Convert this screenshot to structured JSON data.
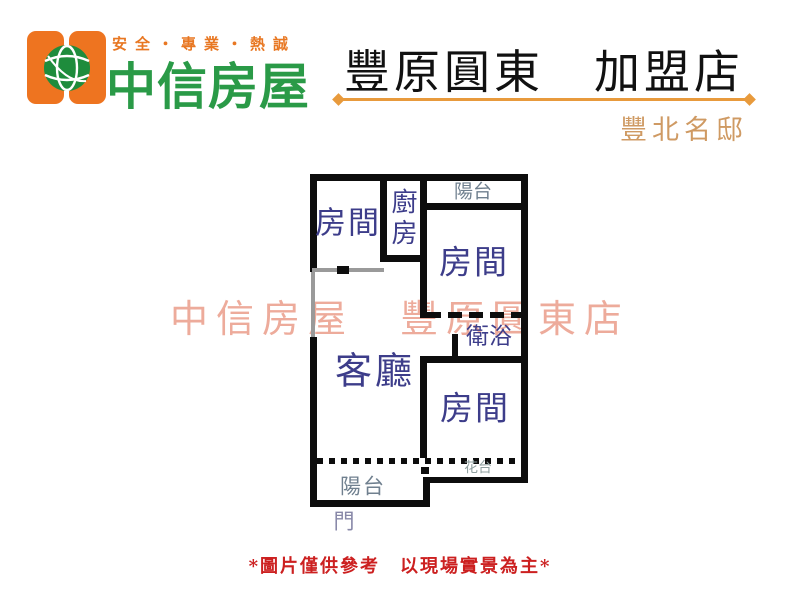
{
  "header": {
    "slogan": "安全・專業・熱誠",
    "brand": "中信房屋",
    "store_title": "豐原圓東　加盟店",
    "property_name": "豐北名邸",
    "colors": {
      "brand_orange": "#ee7420",
      "slogan_orange": "#e87722",
      "brand_green": "#2a9a47",
      "title_black": "#111111",
      "divider_orange": "#e89a3c",
      "property_tan": "#cf9a63"
    }
  },
  "icons": {
    "logo_globe": "globe-icon",
    "divider_ends": "diamond-arrow"
  },
  "floorplan": {
    "watermark": "中信房屋　豐原圓東店",
    "watermark_color": "#e0674a",
    "label_color": "#3d3d8a",
    "wall_color": "#0d0d0d",
    "gray_wall_color": "#9a9a9a",
    "rooms": [
      {
        "id": "bedroom-1",
        "label": "房間"
      },
      {
        "id": "kitchen",
        "label": "廚房"
      },
      {
        "id": "balcony-top",
        "label": "陽台"
      },
      {
        "id": "bedroom-2",
        "label": "房間"
      },
      {
        "id": "bathroom",
        "label": "衛浴"
      },
      {
        "id": "living-room",
        "label": "客廳"
      },
      {
        "id": "bedroom-3",
        "label": "房間"
      },
      {
        "id": "flower-bed",
        "label": "花台"
      },
      {
        "id": "balcony-bottom",
        "label": "陽台"
      },
      {
        "id": "door",
        "label": "門"
      }
    ]
  },
  "footer": {
    "disclaimer": "*圖片僅供參考　以現場實景為主*",
    "color": "#cc2020"
  }
}
